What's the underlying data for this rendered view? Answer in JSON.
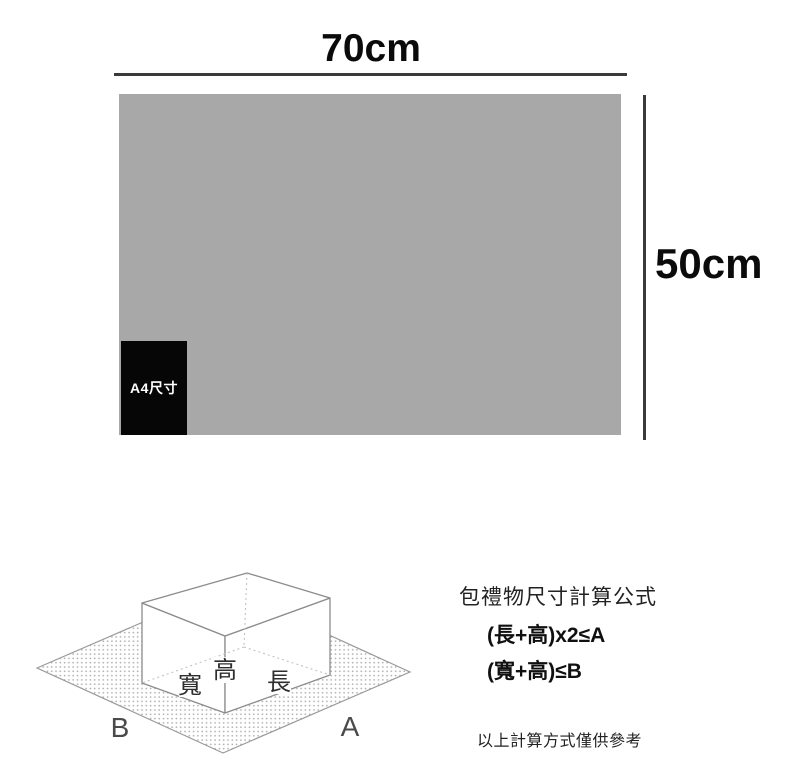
{
  "ruler": {
    "width_label": "70cm",
    "height_label": "50cm",
    "a4_label": "A4尺寸",
    "sheet_color": "#a8a8a8",
    "a4_box_color": "#060606",
    "dimension_line_color": "#3a3a3a"
  },
  "wrap_diagram": {
    "label_width": "寬",
    "label_height": "高",
    "label_length": "長",
    "label_sheet_b": "B",
    "label_sheet_a": "A",
    "dot_color": "#b0b0b0",
    "edge_color": "#8c8c8c"
  },
  "formulas": {
    "title": "包禮物尺寸計算公式",
    "formula_a": "(長+高)x2≤A",
    "formula_b": "(寬+高)≤B",
    "note": "以上計算方式僅供參考"
  }
}
